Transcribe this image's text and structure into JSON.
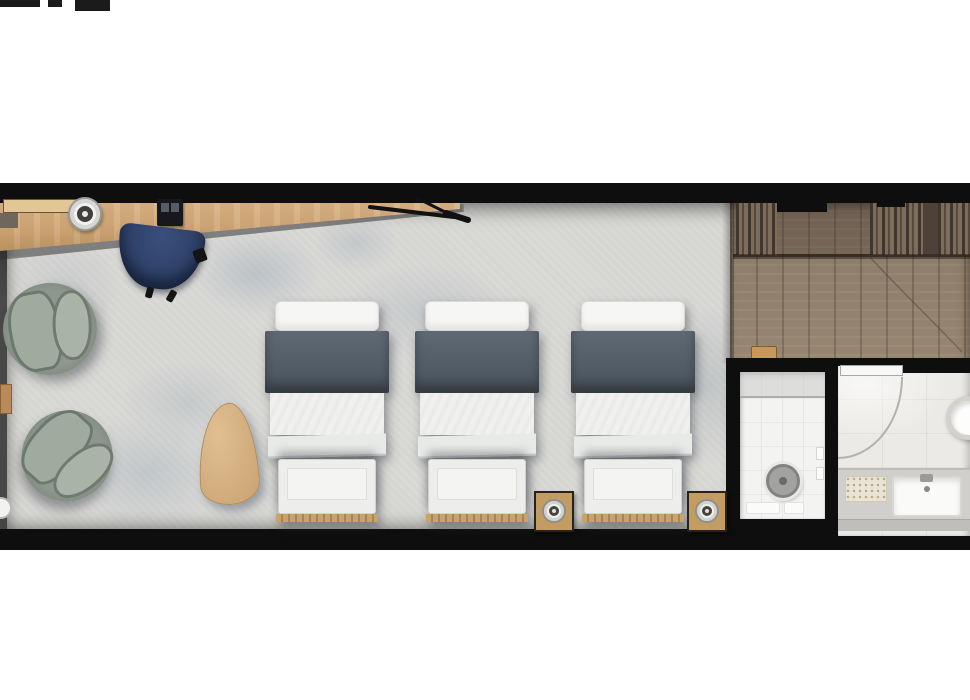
{
  "scene": {
    "type": "floor-plan",
    "labels": {
      "plan": "Hotel room floor plan",
      "bedroom": "Bedroom and lounge with carpet floor",
      "entry": "Entry hall with hardwood floor",
      "wardrobe": "Wardrobe with hanging clothes",
      "desk": "Wooden desk",
      "desk_lamp": "Round lamp on desk",
      "dock": "Telephone dock on desk",
      "scissors": "Desk accessory",
      "task_chair": "Navy desk chair",
      "armchair": "Round lounge armchair",
      "teardrop_table": "Teardrop accent table",
      "wall_table": "Small wall-side table",
      "bed": "Single bed with dark runner and foot bench",
      "night_table": "Bedside table with lamp",
      "shower": "Shower room",
      "shower_head": "Overhead rain shower",
      "bathroom": "Bathroom",
      "door": "Bathroom door with swing arc",
      "basin": "Round washbasin",
      "vanity": "Vanity counter with sink",
      "sink": "Vanity sink",
      "shoes": "Slippers at bathroom entrance"
    }
  },
  "colors": {
    "page_bg": "#ffffff",
    "wall": "#0e0e0e",
    "carpet": "#d9d9d6",
    "desk_wood": "#d0a877",
    "shelf_wood": "#e3c695",
    "chair_navy": "#2c3e63",
    "armchair_rim": "#6f7a6f",
    "armchair_back": "#9fab9f",
    "armchair_seat": "#a9b3a7",
    "side_table_wood": "#c39c62",
    "teardrop_wood": "#c9a271",
    "bed_band": "#49535d",
    "bed_linen": "#f0f1ef",
    "entry_wood": "#8f7e6b",
    "bath_tile_white": "#f3f3f1",
    "bath_tile_gray": "#eceae6",
    "vanity_counter": "#d0cfcc",
    "shower_head": "#a2a2a0"
  }
}
